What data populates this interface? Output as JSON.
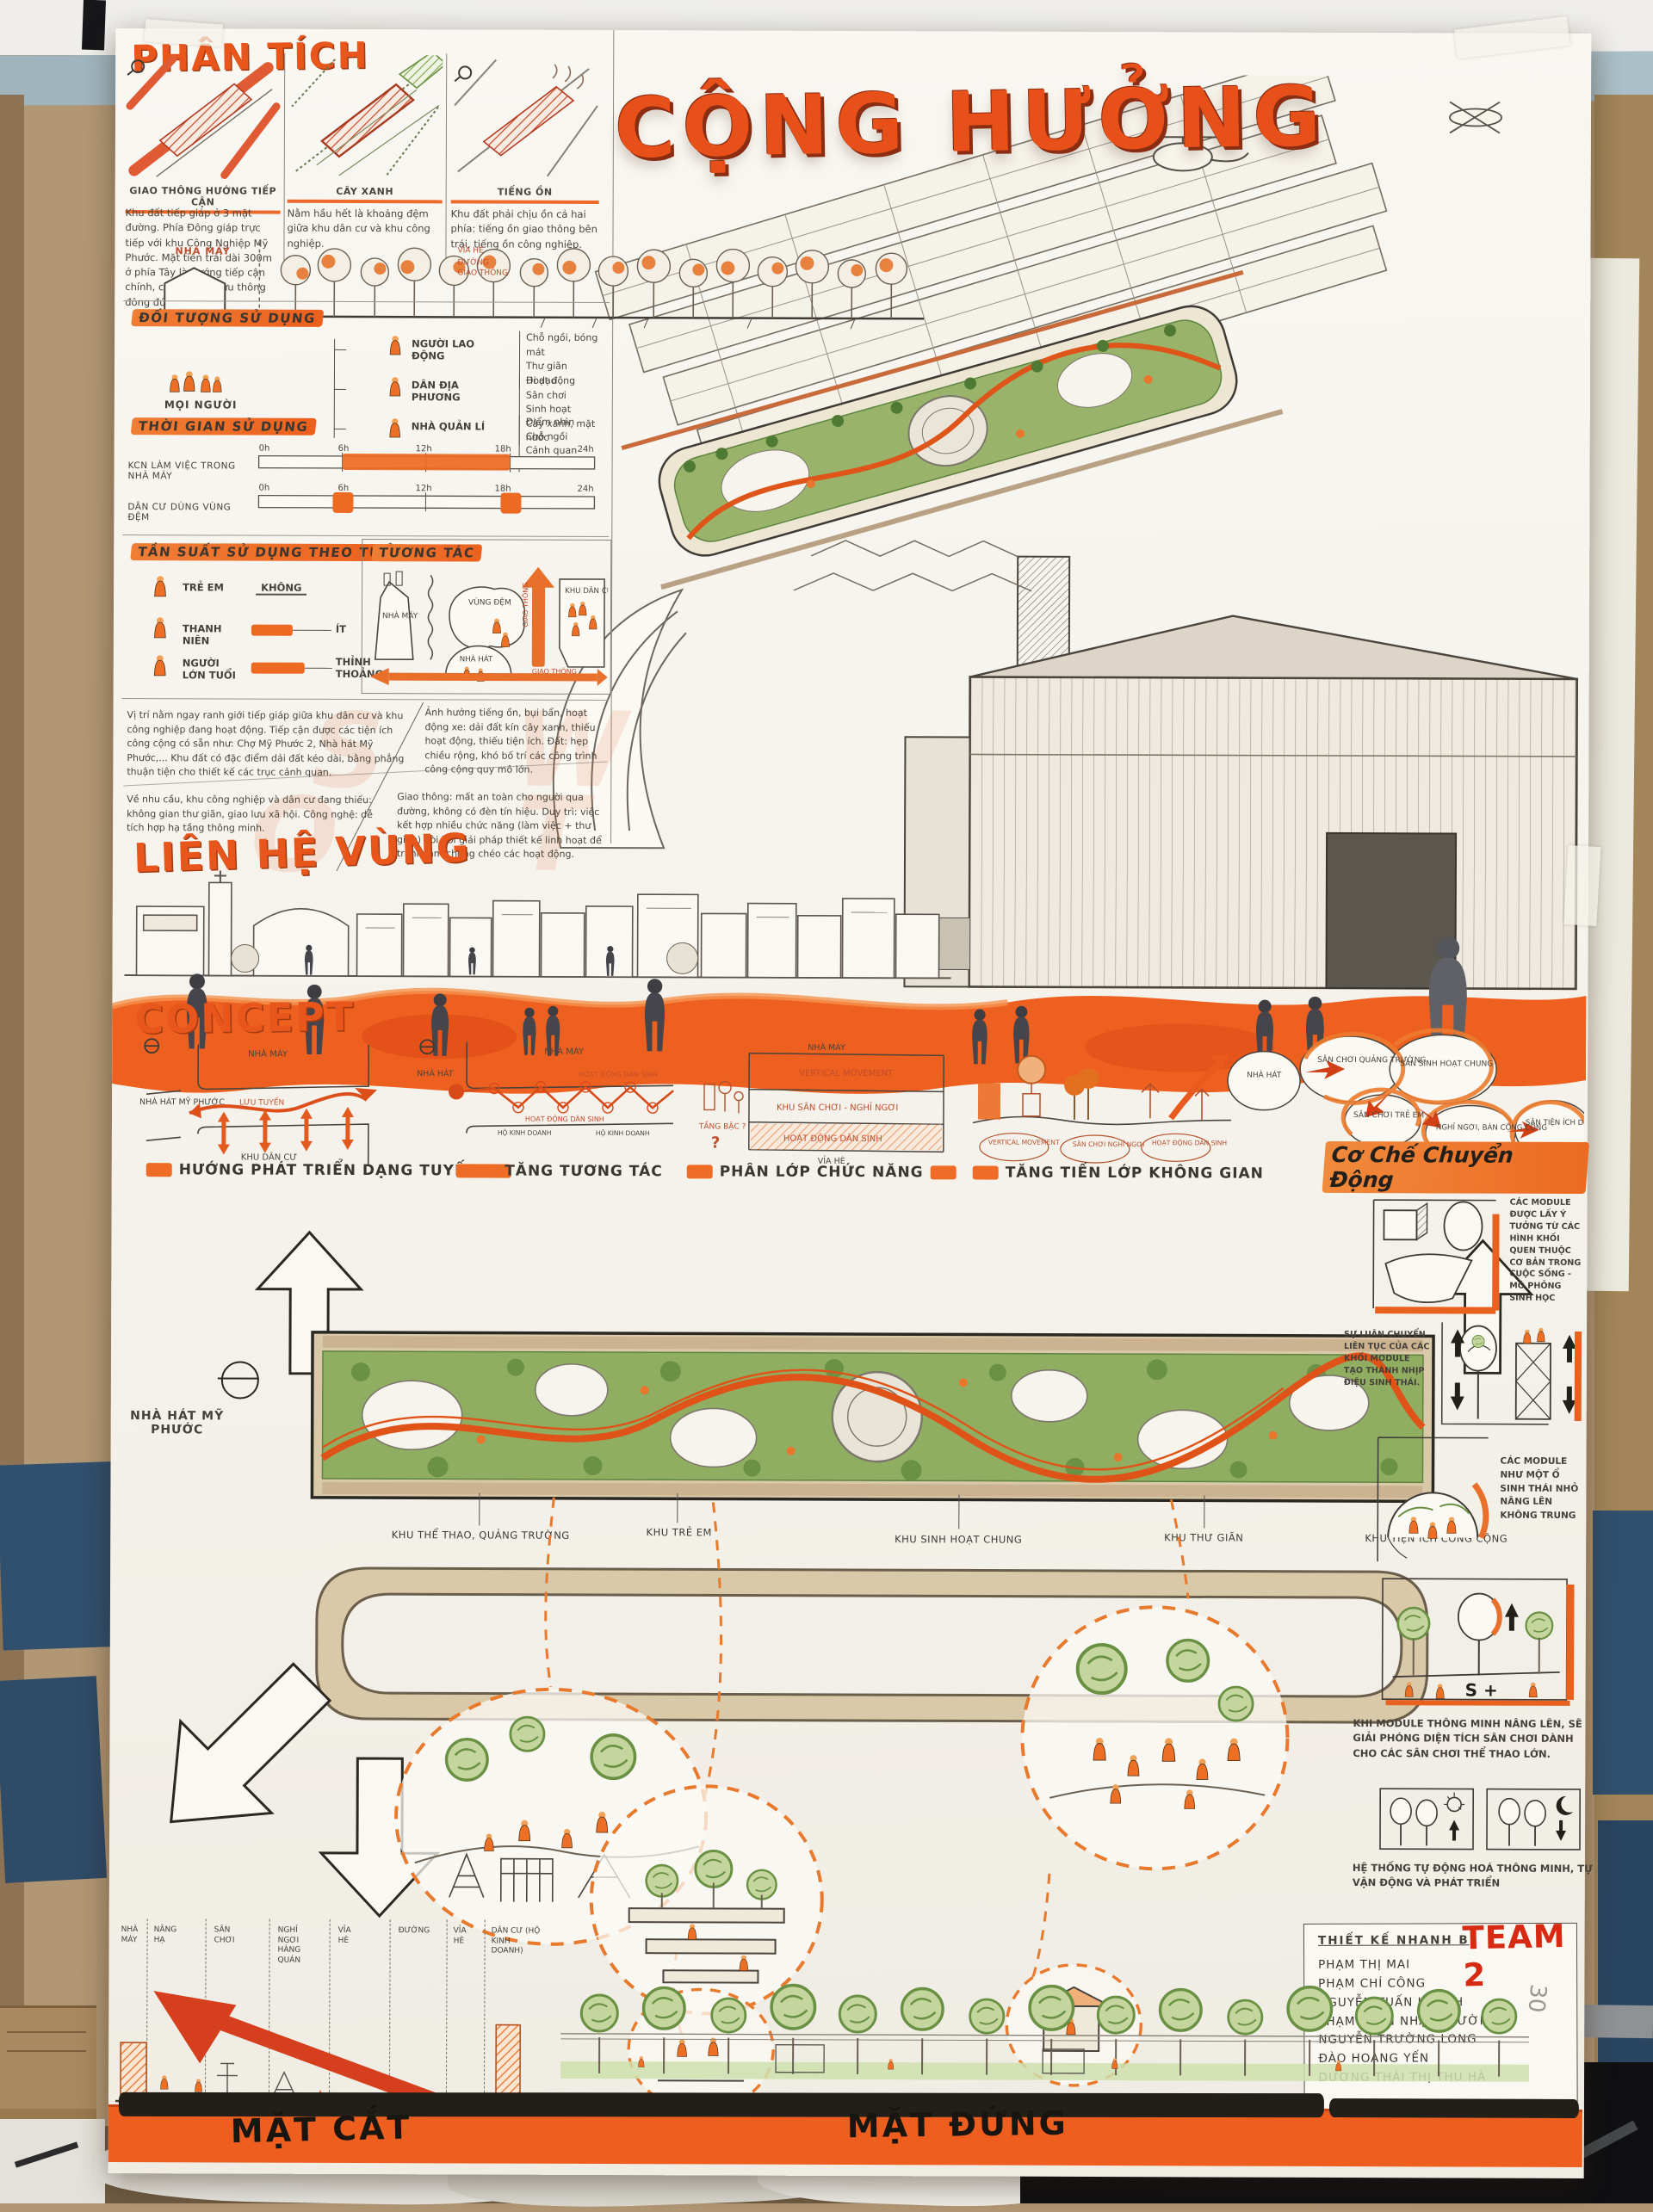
{
  "scene": {
    "pencil_note": "30"
  },
  "poster": {
    "title": "CỘNG HƯỞNG",
    "analysis": {
      "heading": "PHÂN TÍCH",
      "panels": [
        {
          "caption": "GIAO THÔNG HƯỚNG TIẾP CẬN",
          "body": "Khu đất tiếp giáp ở 3 mặt đường. Phía Đông giáp trực tiếp với khu Công Nghiệp Mỹ Phước. Mặt tiền trải dài 300m ở phía Tây là hướng tiếp cận chính, có lượng xe lưu thông đông đúc."
        },
        {
          "caption": "CÂY XANH",
          "body": "Nằm hầu hết là khoảng đệm giữa khu dân cư và khu công nghiệp."
        },
        {
          "caption": "TIẾNG ỒN",
          "body": "Khu đất phải chịu ồn cả hai phía: tiếng ồn giao thông bên trái, tiếng ồn công nghiệp."
        }
      ],
      "buffer": {
        "factory_label": "NHÀ MÁY",
        "sidewalk_label": "VỈA HÈ",
        "road_label": "ĐƯỜNG GIAO THÔNG"
      }
    },
    "users": {
      "heading": "ĐỐI TƯỢNG SỬ DỤNG",
      "root_label": "MỌI NGƯỜI",
      "groups": [
        {
          "label": "NGƯỜI LAO ĐỘNG",
          "needs": [
            "Chỗ ngồi, bóng mát",
            "Thư giãn",
            "Hoạt động"
          ]
        },
        {
          "label": "DÂN ĐỊA PHƯƠNG",
          "needs": [
            "Đi dạo",
            "Sân chơi",
            "Sinh hoạt",
            "Cây xanh, mặt nước"
          ]
        },
        {
          "label": "NHÀ QUẢN LÍ",
          "needs": [
            "Điểm nhìn",
            "Chỗ ngồi",
            "Cảnh quan",
            "Giao lưu"
          ]
        }
      ]
    },
    "time": {
      "heading": "THỜI GIAN SỬ DỤNG",
      "ticks": [
        "0h",
        "6h",
        "12h",
        "18h",
        "24h"
      ],
      "rows": [
        {
          "label": "KCN LÀM VIỆC TRONG NHÀ MÁY"
        },
        {
          "label": "DÂN CƯ DÙNG VÙNG ĐỆM"
        }
      ]
    },
    "frequency": {
      "heading": "TẦN SUẤT SỬ DỤNG THEO TUỔI",
      "rows": [
        {
          "label": "TRẺ EM",
          "value": "KHÔNG"
        },
        {
          "label": "THANH NIÊN",
          "value": "ÍT"
        },
        {
          "label": "NGƯỜI LỚN TUỔI",
          "value": "THỈNH THOẢNG"
        }
      ]
    },
    "interaction": {
      "heading": "TƯƠNG TÁC",
      "factory": "NHÀ MÁY",
      "buffer": "VÙNG ĐỆM",
      "residential": "KHU DÂN CƯ",
      "traffic1": "GIAO THÔNG",
      "traffic2": "GIAO THÔNG",
      "theater": "NHÀ HÁT"
    },
    "swot": {
      "s": "Vị trí nằm ngay ranh giới tiếp giáp giữa khu dân cư và khu công nghiệp đang hoạt động. Tiếp cận được các tiện ích công cộng có sẵn như: Chợ Mỹ Phước 2, Nhà hát Mỹ Phước,... Khu đất có đặc điểm dải đất kéo dài, bằng phẳng thuận tiện cho thiết kế các trục cảnh quan.",
      "w": "Ảnh hưởng tiếng ồn, bụi bẩn, hoạt động xe: dải đất kín cây xanh, thiếu hoạt động, thiếu tiện ích. Đất: hẹp chiều rộng, khó bố trí các công trình công cộng quy mô lớn.",
      "o": "Về nhu cầu, khu công nghiệp và dân cư đang thiếu: không gian thư giãn, giao lưu xã hội. Công nghệ: dễ tích hợp hạ tầng thông minh.",
      "t": "Giao thông: mất an toàn cho người qua đường, không có đèn tín hiệu. Duy trì: việc kết hợp nhiều chức năng (làm việc + thư giãn) đòi hỏi giải pháp thiết kế linh hoạt để tránh làm chồng chéo các hoạt động."
    },
    "region_heading": "LIÊN HỆ VÙNG",
    "concept": {
      "heading": "CONCEPT",
      "p1": {
        "theater": "NHÀ HÁT MỸ PHƯỚC",
        "factory": "NHÀ MÁY",
        "flow": "LƯU TUYẾN",
        "residential": "KHU DÂN CƯ",
        "caption": "HƯỚNG PHÁT TRIỂN DẠNG TUYẾN"
      },
      "p2": {
        "theater": "NHÀ HÁT",
        "factory": "NHÀ MÁY",
        "activity": "HOẠT ĐỘNG DÂN SINH",
        "household": "HỘ KINH DOANH",
        "caption": "TĂNG TƯƠNG TÁC"
      },
      "p3": {
        "factory": "NHÀ MÁY",
        "l1": "VERTICAL MOVEMENT",
        "l2": "KHU SÂN CHƠI - NGHỈ NGƠI",
        "l3": "HOẠT ĐỘNG DÂN SINH",
        "sidewalk": "VỈA HÈ",
        "side": "TẦNG BẬC ?",
        "caption": "PHÂN LỚP CHỨC NĂNG"
      },
      "p4": {
        "b1": "VERTICAL MOVEMENT",
        "b2": "SÂN CHƠI NGHỈ NGƠI",
        "b3": "HOẠT ĐỘNG DÂN SINH",
        "caption": "TĂNG TIẾN LỚP KHÔNG GIAN"
      },
      "p5": {
        "theater": "NHÀ HÁT",
        "plaza": "SÂN CHƠI QUẢNG TRƯỜNG",
        "common": "SÂN SINH HOẠT CHUNG",
        "kids": "SÂN CHƠI TRẺ EM",
        "rest": "NGHỈ NGƠI, BÁN CÔNG CỘNG",
        "service": "SÂN TIỆN ÍCH DỊCH VỤ"
      }
    },
    "mechanism": {
      "heading": "Cơ Chế Chuyển Động",
      "notes": [
        "CÁC MODULE ĐƯỢC LẤY Ý TƯỞNG TỪ CÁC HÌNH KHỐI QUEN THUỘC CƠ BẢN TRONG CUỘC SỐNG - MÔ PHỎNG SINH HỌC",
        "SỰ LUÂN CHUYỂN LIÊN TỤC CỦA CÁC KHỐI MODULE TẠO THÀNH NHỊP ĐIỆU SINH THÁI.",
        "CÁC MODULE NHƯ MỘT Ổ SINH THÁI NHỎ NÂNG LÊN KHÔNG TRUNG",
        "KHI MODULE THÔNG MINH NÂNG LÊN, SẼ GIẢI PHÓNG DIỆN TÍCH SÂN CHƠI DÀNH CHO CÁC SÂN CHƠI THỂ THAO LỚN.",
        "HỆ THỐNG TỰ ĐỘNG HOÁ THÔNG MINH, TỰ VẬN ĐỘNG VÀ PHÁT TRIỂN"
      ],
      "module_glyph": "S +"
    },
    "plan": {
      "theater": "NHÀ HÁT MỸ PHƯỚC",
      "zones": [
        "KHU THỂ THAO, QUẢNG TRƯỜNG",
        "KHU TRẺ EM",
        "KHU SINH HOẠT CHUNG",
        "KHU THƯ GIÃN",
        "KHU TIỆN ÍCH CÔNG CỘNG"
      ]
    },
    "bottom": {
      "section_label": "MẶT CẮT",
      "elevation_label": "MẶT ĐỨNG",
      "legend": [
        "NHÀ MÁY",
        "NÂNG HẠ",
        "SÂN CHƠI",
        "NGHỈ NGƠI HÀNG QUÁN",
        "VỈA HÈ",
        "ĐƯỜNG",
        "VỈA HÈ",
        "DÂN CƯ (HỘ KINH DOANH)"
      ]
    },
    "team": {
      "subtitle": "THIẾT KẾ NHANH B",
      "name": "TEAM 2",
      "members": [
        "PHẠM THỊ MAI",
        "PHẠM CHÍ CÔNG",
        "NGUYỄN TUẤN KHANH",
        "PHẠM TRẦN NHẬT TRƯỜNG",
        "NGUYỄN TRƯỜNG LONG",
        "ĐÀO HOÀNG YẾN",
        "DƯƠNG THÁI THỊ THU HÀ"
      ]
    }
  }
}
